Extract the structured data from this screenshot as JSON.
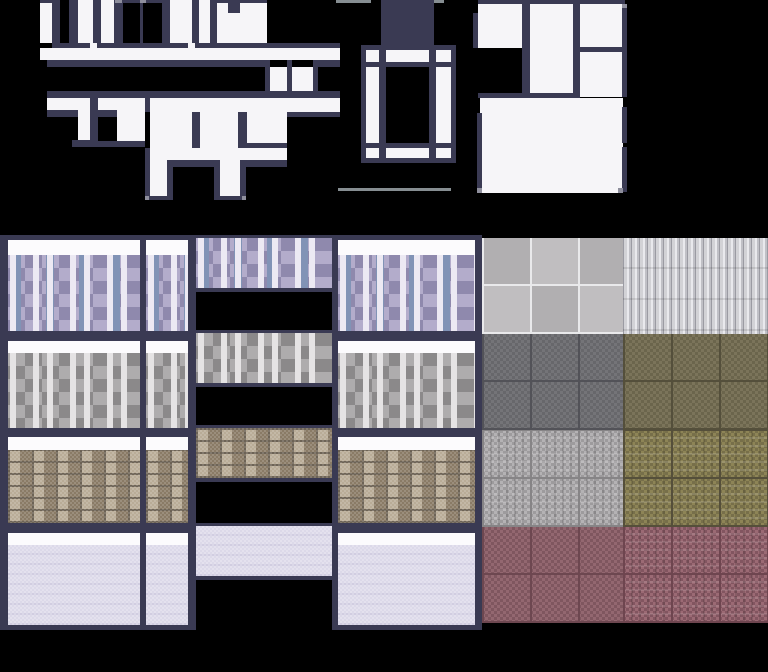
{
  "palette": {
    "background": "#000000",
    "wall_dark": "#3a3a53",
    "room_white": "#f6f5f8",
    "cap_white": "#fcfbfd",
    "corner_gray": "#8f8f9d",
    "tick_gray": "#868e92",
    "lavender_base": "#b3accb",
    "lavender_light": "#c6c0d8",
    "lavender_hi": "#ece9f3",
    "lavender_dark": "#8f89ad",
    "lavender_blue": "#8193b6",
    "graystone_base": "#aeacad",
    "graystone_light": "#c6c4c5",
    "graystone_hi": "#e5e3e4",
    "graystone_dark": "#8b898a",
    "brick_base": "#a1917c",
    "brick_light": "#b9ac97",
    "brick_dark": "#8a7b66",
    "brick_mortar": "#6d6355",
    "plain_base": "#dcd9e9",
    "plain_stripe": "#d1cde1",
    "tile_gray_a": "#c0bec0",
    "tile_gray_b": "#b1afb1",
    "tile_grout": "#e9e9eb",
    "plank_a": "#d2d2d6",
    "plank_b": "#c0c0c6",
    "plank_seam": "#9b9ba3",
    "plank_hi": "#e9e9ed",
    "slate_a": "#747478",
    "slate_b": "#67676b",
    "slate_grid": "#525258",
    "olive_a": "#7b745a",
    "olive_b": "#6b654c",
    "olive_grid": "#544f3b",
    "ornate_gray_a": "#b4b2b4",
    "ornate_gray_b": "#9d9b9d",
    "ornate_gray_grid": "#868486",
    "ornate_olive_a": "#8d8456",
    "ornate_olive_b": "#776f4a",
    "ornate_olive_grid": "#554f3a",
    "maroon_a": "#936770",
    "maroon_b": "#7f565f",
    "maroon_grid": "#6d4750",
    "ornate_maroon_a": "#9b6a74",
    "ornate_maroon_b": "#825560",
    "ornate_maroon_grid": "#6e454f"
  },
  "top_section": {
    "shapes": [
      {
        "name": "roof-line",
        "x": 40,
        "y": 0,
        "w": 12,
        "h": 3,
        "fill": "wall_dark"
      },
      {
        "name": "room-block",
        "x": 40,
        "y": 3,
        "w": 12,
        "h": 40,
        "fill": "room_white"
      },
      {
        "name": "wall-segment",
        "x": 52,
        "y": 0,
        "w": 8,
        "h": 48,
        "fill": "wall_dark"
      },
      {
        "name": "wall-segment",
        "x": 69,
        "y": 0,
        "w": 9,
        "h": 43,
        "fill": "wall_dark"
      },
      {
        "name": "room-block",
        "x": 78,
        "y": 0,
        "w": 15,
        "h": 43,
        "fill": "room_white"
      },
      {
        "name": "wall-segment",
        "x": 93,
        "y": 0,
        "w": 8,
        "h": 48,
        "fill": "wall_dark"
      },
      {
        "name": "room-block",
        "x": 101,
        "y": 0,
        "w": 13,
        "h": 43,
        "fill": "room_white"
      },
      {
        "name": "wall-segment",
        "x": 114,
        "y": 0,
        "w": 9,
        "h": 43,
        "fill": "wall_dark"
      },
      {
        "name": "roof-line",
        "x": 123,
        "y": 0,
        "w": 47,
        "h": 3,
        "fill": "wall_dark"
      },
      {
        "name": "corner-pixel",
        "x": 115,
        "y": 0,
        "w": 7,
        "h": 3,
        "fill": "corner_gray"
      },
      {
        "name": "wall-segment",
        "x": 140,
        "y": 3,
        "w": 3,
        "h": 40,
        "fill": "wall_dark"
      },
      {
        "name": "corner-pixel",
        "x": 140,
        "y": 0,
        "w": 6,
        "h": 3,
        "fill": "corner_gray"
      },
      {
        "name": "wall-segment",
        "x": 162,
        "y": 0,
        "w": 8,
        "h": 48,
        "fill": "wall_dark"
      },
      {
        "name": "room-block",
        "x": 170,
        "y": 0,
        "w": 22,
        "h": 43,
        "fill": "room_white"
      },
      {
        "name": "wall-segment",
        "x": 192,
        "y": 0,
        "w": 7,
        "h": 43,
        "fill": "wall_dark"
      },
      {
        "name": "room-block",
        "x": 199,
        "y": 0,
        "w": 11,
        "h": 43,
        "fill": "room_white"
      },
      {
        "name": "wall-segment",
        "x": 210,
        "y": 0,
        "w": 7,
        "h": 43,
        "fill": "wall_dark"
      },
      {
        "name": "roof-line",
        "x": 217,
        "y": 0,
        "w": 50,
        "h": 3,
        "fill": "wall_dark"
      },
      {
        "name": "room-block",
        "x": 217,
        "y": 3,
        "w": 50,
        "h": 40,
        "fill": "room_white"
      },
      {
        "name": "wall-notch",
        "x": 228,
        "y": 3,
        "w": 12,
        "h": 10,
        "fill": "wall_dark"
      },
      {
        "name": "wall-line",
        "x": 58,
        "y": 43,
        "w": 282,
        "h": 5,
        "fill": "wall_dark"
      },
      {
        "name": "wall-gap",
        "x": 90,
        "y": 43,
        "w": 7,
        "h": 5,
        "fill": "room_white"
      },
      {
        "name": "wall-gap",
        "x": 188,
        "y": 43,
        "w": 7,
        "h": 5,
        "fill": "room_white"
      },
      {
        "name": "floor-band",
        "x": 40,
        "y": 48,
        "w": 300,
        "h": 12,
        "fill": "room_white"
      },
      {
        "name": "wall-line",
        "x": 47,
        "y": 60,
        "w": 220,
        "h": 7,
        "fill": "wall_dark"
      },
      {
        "name": "wall-line",
        "x": 313,
        "y": 60,
        "w": 27,
        "h": 7,
        "fill": "wall_dark"
      },
      {
        "name": "wall-segment",
        "x": 265,
        "y": 60,
        "w": 5,
        "h": 38,
        "fill": "wall_dark"
      },
      {
        "name": "room-strip",
        "x": 270,
        "y": 67,
        "w": 17,
        "h": 31,
        "fill": "room_white"
      },
      {
        "name": "wall-segment",
        "x": 287,
        "y": 60,
        "w": 5,
        "h": 38,
        "fill": "wall_dark"
      },
      {
        "name": "room-strip",
        "x": 292,
        "y": 67,
        "w": 21,
        "h": 31,
        "fill": "room_white"
      },
      {
        "name": "wall-segment",
        "x": 313,
        "y": 67,
        "w": 5,
        "h": 31,
        "fill": "wall_dark"
      },
      {
        "name": "wall-bar",
        "x": 47,
        "y": 91,
        "w": 293,
        "h": 7,
        "fill": "wall_dark"
      },
      {
        "name": "floor-band",
        "x": 47,
        "y": 98,
        "w": 293,
        "h": 14,
        "fill": "room_white"
      },
      {
        "name": "wall-line",
        "x": 47,
        "y": 110,
        "w": 31,
        "h": 7,
        "fill": "wall_dark"
      },
      {
        "name": "room-bar",
        "x": 78,
        "y": 98,
        "w": 12,
        "h": 42,
        "fill": "room_white"
      },
      {
        "name": "wall-segment",
        "x": 90,
        "y": 98,
        "w": 8,
        "h": 49,
        "fill": "wall_dark"
      },
      {
        "name": "wall-line",
        "x": 98,
        "y": 110,
        "w": 19,
        "h": 7,
        "fill": "wall_dark"
      },
      {
        "name": "room-block",
        "x": 117,
        "y": 98,
        "w": 28,
        "h": 43,
        "fill": "room_white"
      },
      {
        "name": "wall-cap",
        "x": 72,
        "y": 140,
        "w": 26,
        "h": 7,
        "fill": "wall_dark"
      },
      {
        "name": "wall-cap",
        "x": 98,
        "y": 141,
        "w": 47,
        "h": 6,
        "fill": "wall_dark"
      },
      {
        "name": "wall-segment",
        "x": 145,
        "y": 98,
        "w": 5,
        "h": 14,
        "fill": "wall_dark"
      },
      {
        "name": "room-big",
        "x": 150,
        "y": 98,
        "w": 137,
        "h": 62,
        "fill": "room_white"
      },
      {
        "name": "wall-segment",
        "x": 192,
        "y": 112,
        "w": 8,
        "h": 36,
        "fill": "wall_dark"
      },
      {
        "name": "wall-segment",
        "x": 238,
        "y": 112,
        "w": 9,
        "h": 36,
        "fill": "wall_dark"
      },
      {
        "name": "wall-line",
        "x": 247,
        "y": 143,
        "w": 40,
        "h": 5,
        "fill": "wall_dark"
      },
      {
        "name": "wall-line",
        "x": 287,
        "y": 112,
        "w": 53,
        "h": 5,
        "fill": "wall_dark"
      },
      {
        "name": "wall-cap",
        "x": 150,
        "y": 160,
        "w": 137,
        "h": 7,
        "fill": "wall_dark"
      },
      {
        "name": "wall-segment",
        "x": 145,
        "y": 148,
        "w": 5,
        "h": 52,
        "fill": "wall_dark"
      },
      {
        "name": "room-leg",
        "x": 150,
        "y": 160,
        "w": 17,
        "h": 36,
        "fill": "room_white"
      },
      {
        "name": "wall-segment",
        "x": 167,
        "y": 160,
        "w": 6,
        "h": 40,
        "fill": "wall_dark"
      },
      {
        "name": "wall-segment",
        "x": 214,
        "y": 160,
        "w": 6,
        "h": 40,
        "fill": "wall_dark"
      },
      {
        "name": "room-leg",
        "x": 220,
        "y": 160,
        "w": 20,
        "h": 36,
        "fill": "room_white"
      },
      {
        "name": "wall-segment",
        "x": 240,
        "y": 160,
        "w": 6,
        "h": 40,
        "fill": "wall_dark"
      },
      {
        "name": "wall-cap",
        "x": 145,
        "y": 196,
        "w": 28,
        "h": 4,
        "fill": "wall_dark"
      },
      {
        "name": "wall-cap",
        "x": 214,
        "y": 196,
        "w": 32,
        "h": 4,
        "fill": "wall_dark"
      },
      {
        "name": "corner-pixel",
        "x": 145,
        "y": 196,
        "w": 4,
        "h": 4,
        "fill": "corner_gray"
      },
      {
        "name": "corner-pixel",
        "x": 242,
        "y": 196,
        "w": 4,
        "h": 4,
        "fill": "corner_gray"
      },
      {
        "name": "roof-tick",
        "x": 336,
        "y": 0,
        "w": 35,
        "h": 3,
        "fill": "tick_gray"
      },
      {
        "name": "roof-tick",
        "x": 434,
        "y": 0,
        "w": 10,
        "h": 3,
        "fill": "tick_gray"
      },
      {
        "name": "chimney",
        "x": 381,
        "y": 0,
        "w": 53,
        "h": 48,
        "fill": "wall_dark"
      },
      {
        "name": "window-frame-outer",
        "x": 361,
        "y": 45,
        "w": 95,
        "h": 118,
        "fill": "wall_dark"
      },
      {
        "name": "window-frame",
        "x": 366,
        "y": 50,
        "w": 85,
        "h": 108,
        "fill": "room_white"
      },
      {
        "name": "window-rail",
        "x": 366,
        "y": 62,
        "w": 85,
        "h": 5,
        "fill": "wall_dark"
      },
      {
        "name": "window-rail",
        "x": 366,
        "y": 143,
        "w": 85,
        "h": 5,
        "fill": "wall_dark"
      },
      {
        "name": "window-stile",
        "x": 379,
        "y": 50,
        "w": 7,
        "h": 108,
        "fill": "wall_dark"
      },
      {
        "name": "window-stile",
        "x": 429,
        "y": 50,
        "w": 7,
        "h": 108,
        "fill": "wall_dark"
      },
      {
        "name": "window-glass",
        "x": 386,
        "y": 67,
        "w": 43,
        "h": 76,
        "fill": "background"
      },
      {
        "name": "sill-line",
        "x": 338,
        "y": 188,
        "w": 113,
        "h": 3,
        "fill": "tick_gray"
      },
      {
        "name": "wall-bar",
        "x": 478,
        "y": 0,
        "w": 147,
        "h": 4,
        "fill": "wall_dark"
      },
      {
        "name": "room-block",
        "x": 478,
        "y": 4,
        "w": 44,
        "h": 44,
        "fill": "room_white"
      },
      {
        "name": "wall-segment",
        "x": 473,
        "y": 13,
        "w": 5,
        "h": 35,
        "fill": "wall_dark"
      },
      {
        "name": "wall-segment",
        "x": 522,
        "y": 0,
        "w": 8,
        "h": 97,
        "fill": "wall_dark"
      },
      {
        "name": "room-block",
        "x": 530,
        "y": 4,
        "w": 43,
        "h": 93,
        "fill": "room_white"
      },
      {
        "name": "wall-segment",
        "x": 573,
        "y": 0,
        "w": 7,
        "h": 97,
        "fill": "wall_dark"
      },
      {
        "name": "room-block",
        "x": 580,
        "y": 4,
        "w": 42,
        "h": 43,
        "fill": "room_white"
      },
      {
        "name": "wall-line",
        "x": 580,
        "y": 47,
        "w": 42,
        "h": 5,
        "fill": "wall_dark"
      },
      {
        "name": "room-block",
        "x": 580,
        "y": 52,
        "w": 42,
        "h": 45,
        "fill": "room_white"
      },
      {
        "name": "wall-segment",
        "x": 622,
        "y": 4,
        "w": 5,
        "h": 93,
        "fill": "wall_dark"
      },
      {
        "name": "wall-bar",
        "x": 478,
        "y": 93,
        "w": 102,
        "h": 5,
        "fill": "wall_dark"
      },
      {
        "name": "room-big",
        "x": 480,
        "y": 98,
        "w": 143,
        "h": 95,
        "fill": "room_white"
      },
      {
        "name": "wall-segment",
        "x": 477,
        "y": 113,
        "w": 5,
        "h": 80,
        "fill": "wall_dark"
      },
      {
        "name": "wall-segment",
        "x": 622,
        "y": 107,
        "w": 5,
        "h": 36,
        "fill": "wall_dark"
      },
      {
        "name": "wall-segment",
        "x": 622,
        "y": 147,
        "w": 5,
        "h": 45,
        "fill": "wall_dark"
      },
      {
        "name": "corner-pixel",
        "x": 622,
        "y": 4,
        "w": 5,
        "h": 4,
        "fill": "corner_gray"
      },
      {
        "name": "corner-pixel",
        "x": 477,
        "y": 188,
        "w": 5,
        "h": 5,
        "fill": "corner_gray"
      },
      {
        "name": "corner-pixel",
        "x": 618,
        "y": 188,
        "w": 5,
        "h": 5,
        "fill": "corner_gray"
      }
    ]
  },
  "tileset": {
    "area": {
      "y": 235,
      "h": 395
    },
    "column_frames": [
      {
        "name": "col-a-frame",
        "x": 0,
        "w": 146
      },
      {
        "name": "col-b-frame",
        "x": 140,
        "w": 56
      },
      {
        "name": "col-d-frame",
        "x": 332,
        "w": 150
      }
    ],
    "columns": [
      {
        "name": "col-a",
        "x": 8,
        "w": 132
      },
      {
        "name": "col-b",
        "x": 146,
        "w": 42
      },
      {
        "name": "col-d",
        "x": 338,
        "w": 137
      }
    ],
    "rows": [
      {
        "texture": "lavender-stone",
        "cap_y": 240,
        "cap_h": 15,
        "tex_y": 255,
        "tex_h": 76
      },
      {
        "texture": "gray-stone",
        "cap_y": 341,
        "cap_h": 12,
        "tex_y": 353,
        "tex_h": 75
      },
      {
        "texture": "brown-brick",
        "cap_y": 437,
        "cap_h": 13,
        "tex_y": 450,
        "tex_h": 73
      },
      {
        "texture": "plain-lavender",
        "cap_y": 533,
        "cap_h": 12,
        "tex_y": 545,
        "tex_h": 80
      }
    ],
    "center_strip": {
      "name": "col-c",
      "left_border": {
        "x": 191,
        "w": 5
      },
      "x": 196,
      "w": 136,
      "band_edge_h": 3,
      "band_tex_h": 50,
      "band_bottom_h": 4,
      "bands": [
        {
          "texture": "lavender-stone",
          "y": 235
        },
        {
          "texture": "gray-stone",
          "y": 330
        },
        {
          "texture": "brown-brick",
          "y": 425
        },
        {
          "texture": "plain-lavender",
          "y": 523
        }
      ]
    },
    "right_blocks": [
      {
        "name": "floor-tiles-gray",
        "x": 482,
        "y": 238,
        "w": 141,
        "h": 96,
        "texture": "floor-tiles-gray"
      },
      {
        "name": "planks-white",
        "x": 623,
        "y": 238,
        "w": 145,
        "h": 96,
        "texture": "planks-white"
      },
      {
        "name": "check-slate",
        "x": 482,
        "y": 334,
        "w": 141,
        "h": 96,
        "texture": "check-slate"
      },
      {
        "name": "check-olive",
        "x": 623,
        "y": 334,
        "w": 145,
        "h": 96,
        "texture": "check-olive"
      },
      {
        "name": "ornate-gray",
        "x": 482,
        "y": 430,
        "w": 141,
        "h": 97,
        "texture": "ornate-gray"
      },
      {
        "name": "ornate-olive",
        "x": 623,
        "y": 430,
        "w": 145,
        "h": 97,
        "texture": "ornate-olive"
      },
      {
        "name": "check-maroon",
        "x": 482,
        "y": 527,
        "w": 141,
        "h": 96,
        "texture": "check-maroon"
      },
      {
        "name": "ornate-maroon",
        "x": 623,
        "y": 527,
        "w": 145,
        "h": 96,
        "texture": "ornate-maroon"
      }
    ]
  }
}
